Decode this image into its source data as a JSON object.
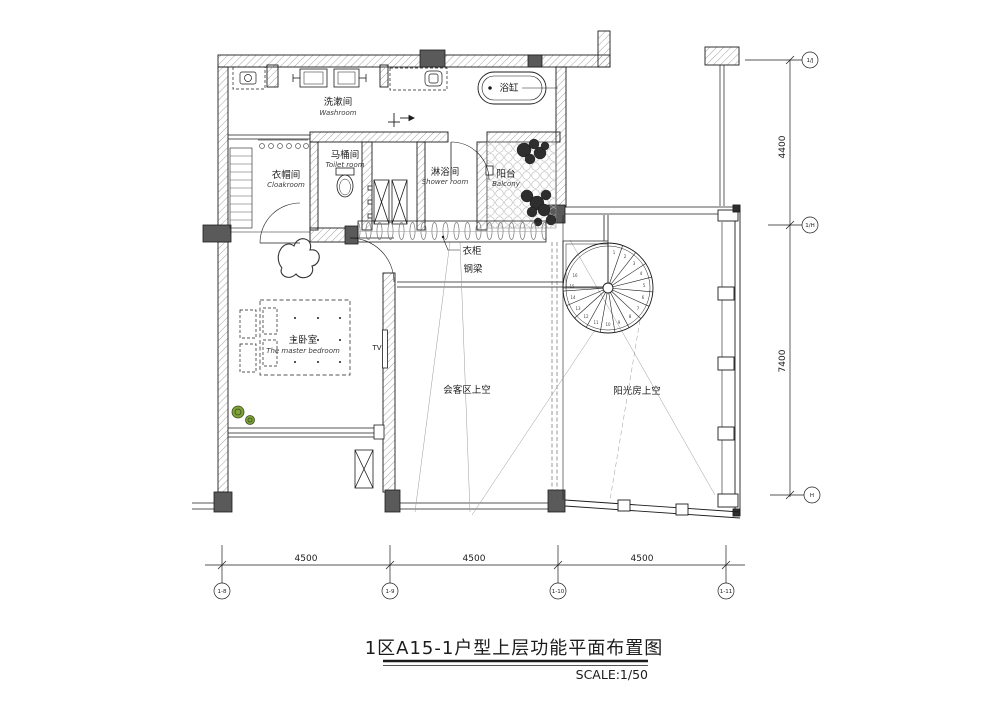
{
  "title": {
    "text": "1区A15-1户型上层功能平面布置图",
    "scale_label": "SCALE:1/50"
  },
  "rooms": {
    "washroom": {
      "zh": "洗漱间",
      "en": "Washroom"
    },
    "toilet": {
      "zh": "马桶间",
      "en": "Toilet room"
    },
    "cloakroom": {
      "zh": "衣帽间",
      "en": "Cloakroom"
    },
    "shower": {
      "zh": "淋浴间",
      "en": "Shower room"
    },
    "balcony": {
      "zh": "阳台",
      "en": "Balcony"
    },
    "master_bedroom": {
      "zh": "主卧室",
      "en": "The master bedroom"
    },
    "living_void": {
      "zh": "会客区上空"
    },
    "sunroom_void": {
      "zh": "阳光房上空"
    }
  },
  "fixtures": {
    "bathtub": "浴缸",
    "wardrobe": "衣柜",
    "steel_beam": "钢梁",
    "tv": "TV"
  },
  "dimensions": {
    "right": [
      "4400",
      "7400"
    ],
    "bottom": [
      "4500",
      "4500",
      "4500"
    ]
  },
  "grid": {
    "right": [
      "1/J",
      "1/H",
      "H"
    ],
    "bottom": [
      "1-8",
      "1-9",
      "1-10",
      "1-11"
    ]
  },
  "stair": {
    "steps": [
      "1",
      "2",
      "3",
      "4",
      "5",
      "6",
      "7",
      "8",
      "9",
      "10",
      "11",
      "12",
      "13",
      "14",
      "15",
      "16"
    ]
  },
  "colors": {
    "line": "#1c1c1c",
    "wall_fill": "#5a5a5a",
    "hatch": "#8c8c8c",
    "paving": "#bdbdbd",
    "plant_green": "#7fa33a",
    "plant_dark": "#2e2e2e"
  }
}
